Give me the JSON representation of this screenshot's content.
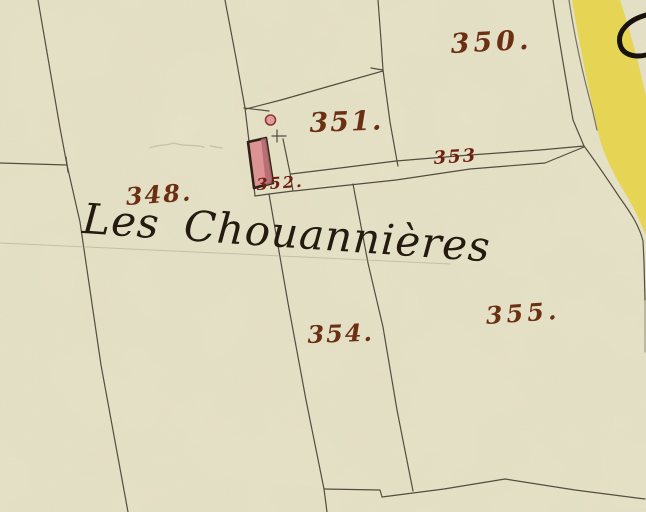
{
  "map": {
    "type": "cadastral-map-scan",
    "place_name": "Les Chouannières",
    "parcels": [
      {
        "number": "348",
        "label": "348."
      },
      {
        "number": "350",
        "label": "350."
      },
      {
        "number": "351",
        "label": "351."
      },
      {
        "number": "352",
        "label": "352."
      },
      {
        "number": "353",
        "label": "353"
      },
      {
        "number": "354",
        "label": "354."
      },
      {
        "number": "355",
        "label": "355."
      }
    ],
    "features": [
      "building",
      "well",
      "road"
    ]
  },
  "colors": {
    "paper": "#e8e4c9",
    "road": "#e6d44b",
    "building": "#dd9294",
    "buildingShade": "#b26a6e",
    "line": "#453d31",
    "inkLabel": "#6b2f12",
    "inkLabelDark": "#6e2012",
    "inkScript": "#241a10"
  }
}
